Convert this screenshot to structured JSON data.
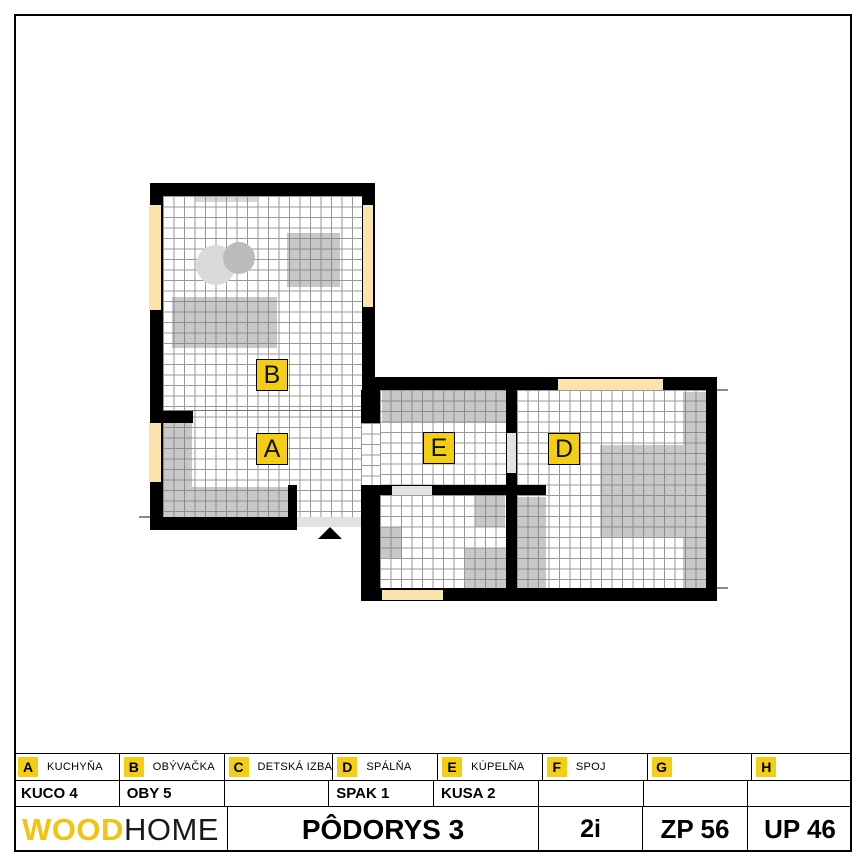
{
  "plan": {
    "room_labels": {
      "a": "A",
      "b": "B",
      "d": "D",
      "e": "E"
    },
    "colors": {
      "label_bg": "#F3CE14",
      "wall": "#000000",
      "window_fill": "#FBE3AC",
      "door_opening": "#E2E2E2",
      "grid_line": "#999999",
      "furniture": "#C7C7C7"
    }
  },
  "legend": {
    "items": [
      {
        "letter": "A",
        "label": "KUCHYŇA"
      },
      {
        "letter": "B",
        "label": "OBÝVAČKA"
      },
      {
        "letter": "C",
        "label": "DETSKÁ IZBA"
      },
      {
        "letter": "D",
        "label": "SPÁLŇA"
      },
      {
        "letter": "E",
        "label": "KÚPELŇA"
      },
      {
        "letter": "F",
        "label": "SPOJ"
      },
      {
        "letter": "G",
        "label": ""
      },
      {
        "letter": "H",
        "label": ""
      }
    ],
    "values": [
      "KUCO 4",
      "OBY 5",
      "",
      "SPAK 1",
      "KUSA 2",
      "",
      "",
      ""
    ]
  },
  "footer": {
    "brand_wood": "WOOD",
    "brand_home": "HOME",
    "title": "PÔDORYS 3",
    "layout_code": "2i",
    "zp": "ZP 56",
    "up": "UP 46"
  }
}
